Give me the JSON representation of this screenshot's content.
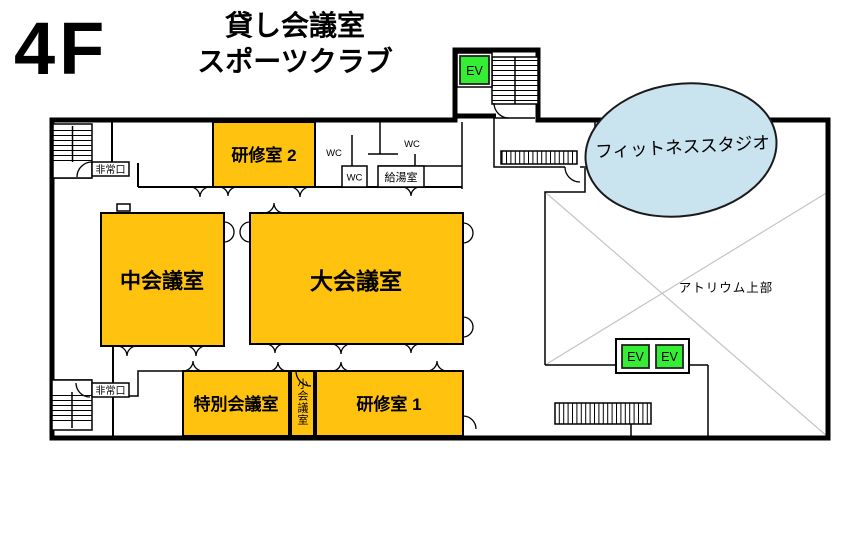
{
  "floor_label": "4F",
  "building_use": {
    "line1": "貸し会議室",
    "line2": "スポーツクラブ"
  },
  "rooms": {
    "training_room_2": "研修室 2",
    "medium_conference": "中会議室",
    "large_conference": "大会議室",
    "special_conference": "特別会議室",
    "small_conference": "小会議室",
    "training_room_1": "研修室 1",
    "fitness_studio": "フィットネススタジオ",
    "atrium_upper": "アトリウム上部",
    "kitchenette": "給湯室"
  },
  "labels": {
    "wc": "WC",
    "emergency_exit": "非常口",
    "elevator": "EV"
  },
  "colors": {
    "room_fill": "#ffc20e",
    "elevator_fill": "#35ed35",
    "studio_fill": "#c9e3ef",
    "wall": "#000000",
    "atrium_line": "#c4c4c4"
  }
}
